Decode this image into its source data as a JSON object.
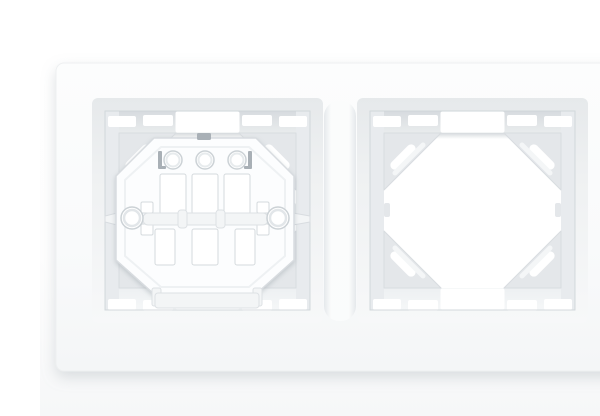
{
  "meta": {
    "content_type": "product photograph",
    "subject": "White two-gang (double) electrical wall-plate frame viewed front-on; left aperture holds an octagonal mounting support plate, right aperture is an empty opening",
    "background": "plain white seamless studio background",
    "text_on_screen": "none"
  },
  "colors": {
    "background": "#ffffff",
    "opening": "#ffffff",
    "frame_face": "#fafbfc",
    "frame_edge": "#eef0f1",
    "wall_top": "#d7dbdf",
    "wall_mid": "#e8ebee",
    "wall_bottom": "#f1f4f5",
    "brace": "#e4e7ea",
    "outline": "#d8dce0",
    "plate": "#fcfdfe",
    "plate_shade": "#f3f5f6",
    "slot_dark": "#a9b0b6",
    "shadow": "#9aa4ab"
  },
  "scene": {
    "frame": {
      "modules": 2,
      "description": "rectangular white plastic frame, rounded corners, two square window apertures separated by a raised rounded center post",
      "apertures": [
        {
          "id": "left",
          "content": "octagonal mounting support plate",
          "features": {
            "round_holes_top_row": 3,
            "angular_dark_slots_beside_holes": 2,
            "upper_vertical_slots": 3,
            "lower_vertical_slots": 3,
            "side_screw_holes": 2,
            "stacked_square_slots_per_side": 2,
            "horizontal_cross_bar": 1,
            "cross_bar_nubs": 2,
            "expansion_claw_tips": 2,
            "bottom_flap_tab": 1,
            "corner_braces": 4,
            "edge_clip_notches_top": 4,
            "edge_clip_notches_bottom": 4,
            "center_edge_cutouts": 2
          }
        },
        {
          "id": "right",
          "content": "empty opening showing white background",
          "features": {
            "corner_braces": 4,
            "corner_brace_slots": 4,
            "edge_clip_notches_top": 4,
            "edge_clip_notches_bottom": 4,
            "center_edge_cutouts": 2,
            "mid_side_tabs": 2
          }
        }
      ]
    }
  }
}
